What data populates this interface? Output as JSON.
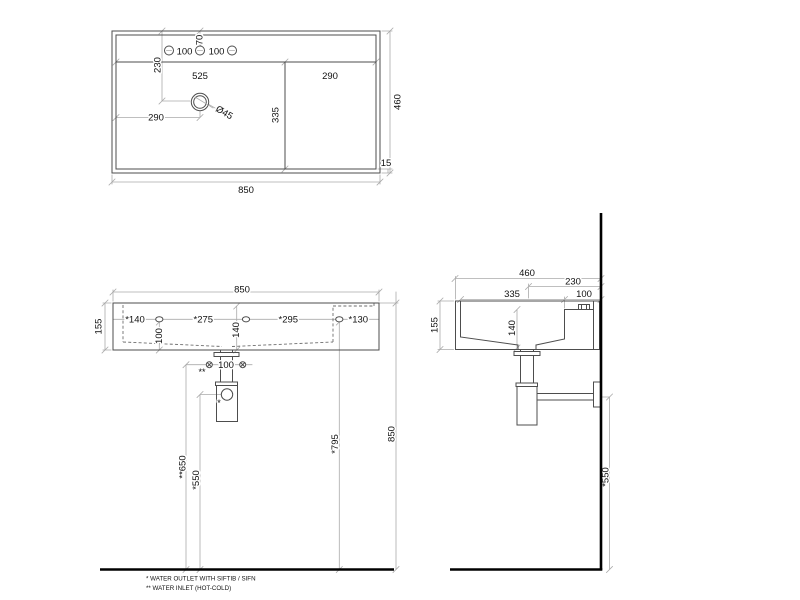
{
  "drawing": {
    "colors": {
      "object_line": "#4d4d4d",
      "dimension_line": "#ababab",
      "wall_floor": "#000000",
      "text": "#111111",
      "background": "#ffffff"
    },
    "top_view": {
      "width": "850",
      "depth": "460",
      "rim": "15",
      "basin_width": "525",
      "deck_width": "290",
      "basin_depth": "335",
      "drain_from_left": "290",
      "drain_from_top": "230",
      "hole_offset": "70",
      "hole_gap_left": "100",
      "hole_gap_right": "100",
      "drain_diameter": "Ø45"
    },
    "front_view": {
      "width": "850",
      "height": "155",
      "slot_dims": [
        "*140",
        "*275",
        "*295",
        "*130"
      ],
      "slot_height": "100",
      "inner_depth": "140",
      "inlet_gap": "100",
      "inlet_mark": "**",
      "outlet_mark": "*",
      "inlet_height": "**650",
      "outlet_height": "*550",
      "slot_floor_height": "*795",
      "rim_height": "850"
    },
    "side_view": {
      "depth": "460",
      "drain_from_wall": "230",
      "deck_depth": "100",
      "inner_length": "335",
      "height": "155",
      "inner_depth": "140",
      "outlet_height": "*550"
    },
    "notes": [
      "* WATER OUTLET WITH SIFTIB / SIFN",
      "** WATER INLET  (HOT-COLD)"
    ]
  }
}
